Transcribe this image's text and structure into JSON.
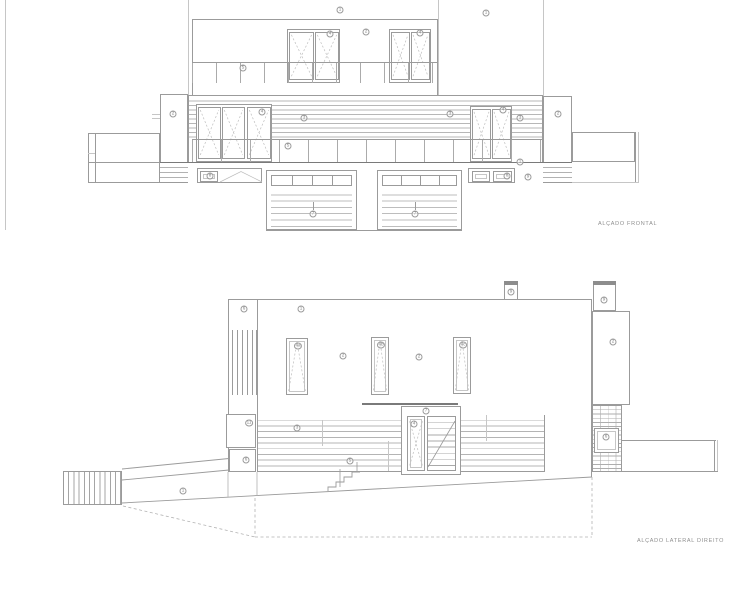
{
  "front_elevation": {
    "title": "ALÇADO FRONTAL",
    "labels": [
      {
        "t": "1",
        "x": 340,
        "y": 10
      },
      {
        "t": "1",
        "x": 486,
        "y": 13
      },
      {
        "t": "4",
        "x": 330,
        "y": 34
      },
      {
        "t": "2",
        "x": 366,
        "y": 32
      },
      {
        "t": "4",
        "x": 420,
        "y": 33
      },
      {
        "t": "5",
        "x": 243,
        "y": 68
      },
      {
        "t": "2",
        "x": 173,
        "y": 114
      },
      {
        "t": "4",
        "x": 262,
        "y": 112
      },
      {
        "t": "3",
        "x": 304,
        "y": 118
      },
      {
        "t": "5",
        "x": 288,
        "y": 146
      },
      {
        "t": "3",
        "x": 450,
        "y": 114
      },
      {
        "t": "4",
        "x": 503,
        "y": 110
      },
      {
        "t": "3",
        "x": 520,
        "y": 118
      },
      {
        "t": "2",
        "x": 558,
        "y": 114
      },
      {
        "t": "8",
        "x": 210,
        "y": 176
      },
      {
        "t": "7",
        "x": 313,
        "y": 214
      },
      {
        "t": "7",
        "x": 415,
        "y": 214
      },
      {
        "t": "8",
        "x": 507,
        "y": 176
      },
      {
        "t": "1",
        "x": 520,
        "y": 162
      },
      {
        "t": "9",
        "x": 528,
        "y": 177
      }
    ]
  },
  "lateral_elevation": {
    "title": "ALÇADO LATERAL DIREITO",
    "labels": [
      {
        "t": "6",
        "x": 244,
        "y": 309
      },
      {
        "t": "1",
        "x": 301,
        "y": 309
      },
      {
        "t": "4a",
        "x": 298,
        "y": 346
      },
      {
        "t": "2",
        "x": 343,
        "y": 356
      },
      {
        "t": "4b",
        "x": 381,
        "y": 345
      },
      {
        "t": "2",
        "x": 419,
        "y": 357
      },
      {
        "t": "4c",
        "x": 463,
        "y": 345
      },
      {
        "t": "9",
        "x": 511,
        "y": 292
      },
      {
        "t": "9",
        "x": 604,
        "y": 300
      },
      {
        "t": "2",
        "x": 613,
        "y": 342
      },
      {
        "t": "11",
        "x": 249,
        "y": 423
      },
      {
        "t": "3",
        "x": 297,
        "y": 428
      },
      {
        "t": "6",
        "x": 246,
        "y": 460
      },
      {
        "t": "7",
        "x": 426,
        "y": 411
      },
      {
        "t": "4",
        "x": 414,
        "y": 424
      },
      {
        "t": "5",
        "x": 350,
        "y": 461
      },
      {
        "t": "6",
        "x": 606,
        "y": 437
      },
      {
        "t": "1",
        "x": 183,
        "y": 491
      }
    ]
  },
  "colors": {
    "background": "#ffffff",
    "line": "#9b9b9b",
    "line_faint": "#c6c6c6",
    "line_dark": "#7a7a7a",
    "label_text": "#808080"
  }
}
